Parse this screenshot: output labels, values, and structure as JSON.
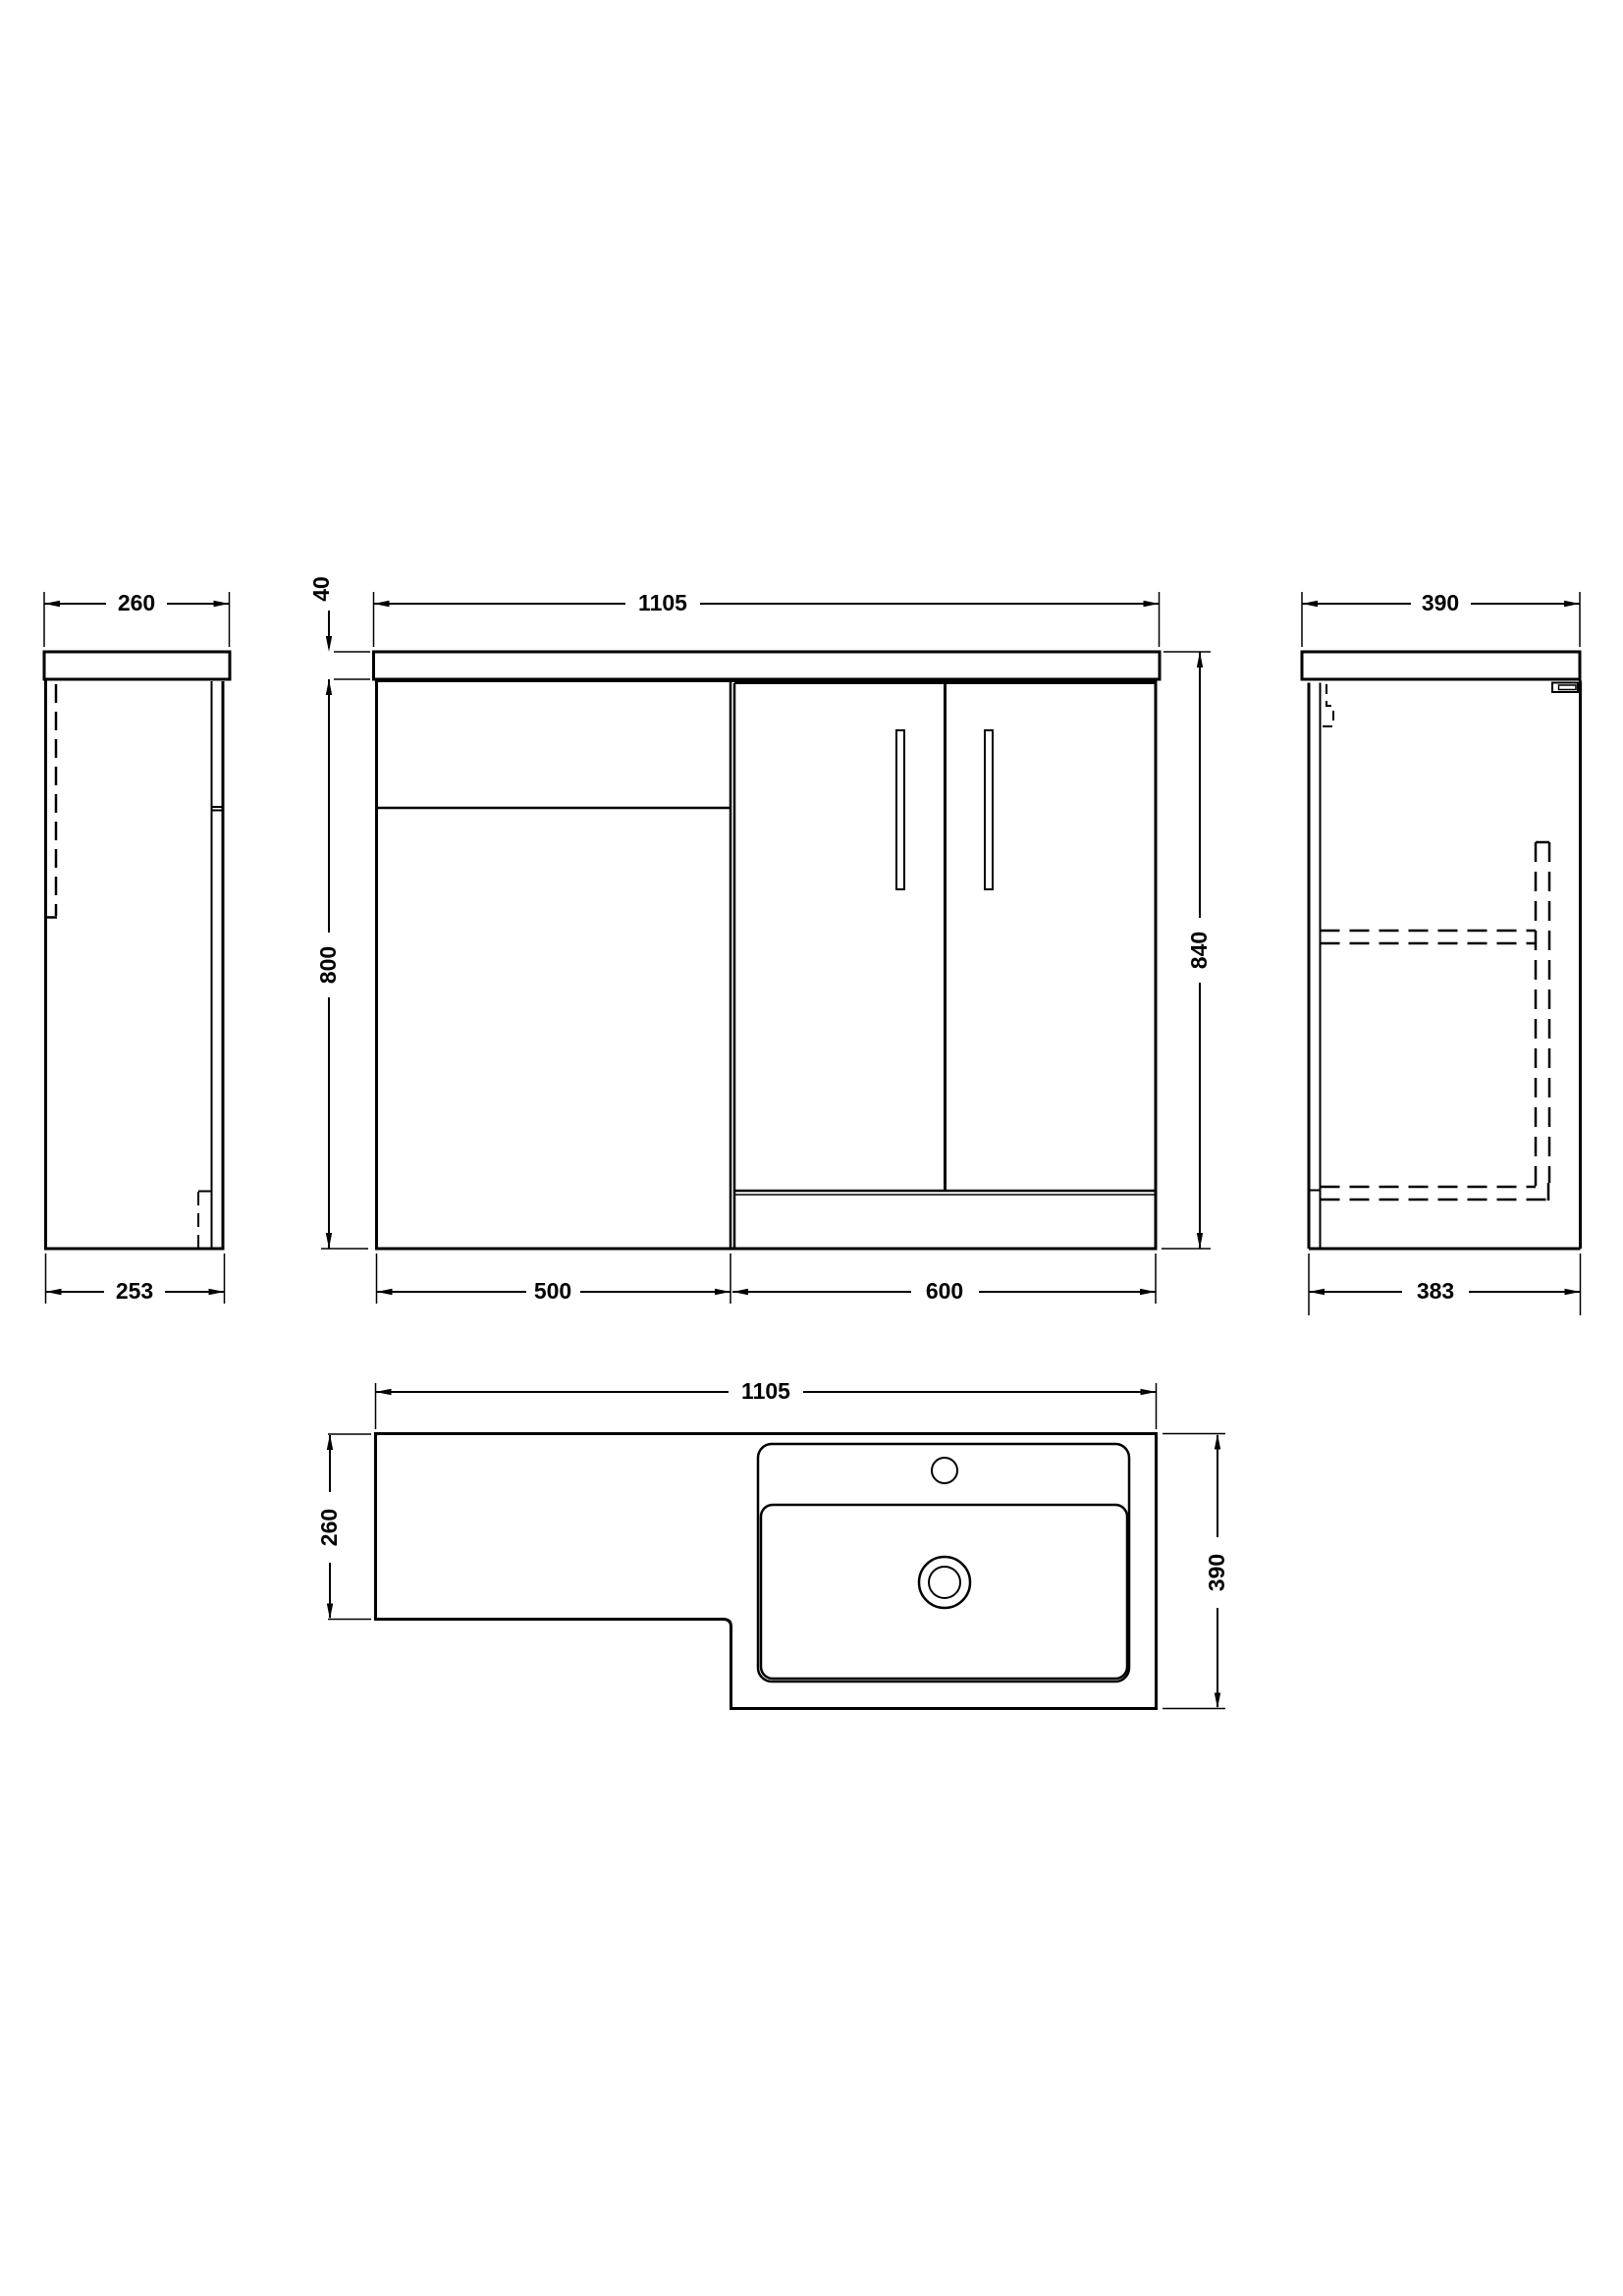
{
  "drawing": {
    "background_color": "#ffffff",
    "line_color": "#000000",
    "type": "technical-dimension-drawing",
    "subject": "L-shaped combination vanity and WC bathroom furniture unit"
  },
  "front_view": {
    "worktop_width": "1105",
    "worktop_thickness": "40",
    "cabinet_height": "800",
    "total_height": "840",
    "wc_unit_width": "500",
    "vanity_unit_width": "600"
  },
  "left_side_view": {
    "worktop_depth": "260",
    "cabinet_depth": "253"
  },
  "right_side_view": {
    "worktop_depth": "390",
    "cabinet_depth": "383"
  },
  "plan_view": {
    "overall_width": "1105",
    "wc_section_depth": "260",
    "basin_section_depth": "390"
  }
}
